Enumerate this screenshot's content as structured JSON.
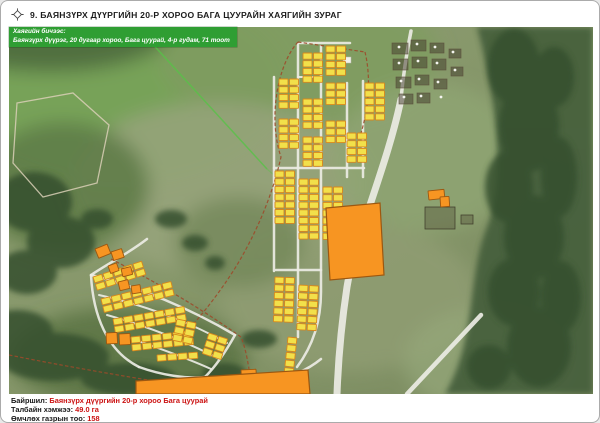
{
  "header": {
    "title": "9. БАЯНЗҮРХ ДҮҮРГИЙН 20-Р ХОРОО БАГА ЦУУРАЙН ХАЯГИЙН ЗУРАГ"
  },
  "overlay": {
    "label": "Хаягийн бичээс:",
    "address": "Баянзүрх дүүрэг, 20 дугаар хороо, Бага цуурай, 4-р гудам, 71 тоот",
    "bg": "#2f9e33",
    "text_color": "#ffffff"
  },
  "footer": {
    "location_label": "Байршил:",
    "location_value": "Баянзүрх дүүргийн 20-р хороо Бага цуурай",
    "area_label": "Талбайн хэмжээ:",
    "area_value": "49.0 га",
    "count_label": "Өмчлөх газрын тоо:",
    "count_value": "158",
    "value_color": "#cc1414"
  },
  "map": {
    "colors": {
      "base1": "#90a173",
      "base2": "#7b8b60",
      "yellow": "#f2e04a",
      "yellow_stroke": "#d8871c",
      "orange": "#f79522",
      "orange_stroke": "#9c5710",
      "road": "#ececе4",
      "road2": "#ececе4",
      "road_fill": "#ecece4",
      "boundary": "#9c4a2a",
      "green_line": "#58c247",
      "forest": "#46603e",
      "forest_dark": "#35502f",
      "plot_fill": "rgba(66,58,44,0.5)",
      "plot_stroke": "rgba(92,80,60,0.85)",
      "dot": "#f5f5f0",
      "trail": "#d9cfb6"
    },
    "terrain_blobs": [
      [
        110,
        50,
        170,
        100,
        "#76a257",
        0.95
      ],
      [
        290,
        20,
        140,
        70,
        "#7f9c60",
        0.9
      ],
      [
        40,
        -5,
        120,
        40,
        "#4c6a3d",
        0.9
      ],
      [
        210,
        150,
        150,
        85,
        "#97a37b",
        0.85
      ],
      [
        420,
        120,
        95,
        75,
        "#8fa573",
        0.8
      ],
      [
        340,
        260,
        130,
        75,
        "#909d73",
        0.8
      ],
      [
        480,
        325,
        85,
        55,
        "#95a87b",
        0.7
      ],
      [
        55,
        150,
        85,
        65,
        "#5d7a46",
        0.85
      ],
      [
        230,
        205,
        65,
        45,
        "#6f8455",
        0.7
      ],
      [
        575,
        55,
        50,
        60,
        "#8ba66c",
        0.8
      ],
      [
        120,
        320,
        120,
        50,
        "#5a7343",
        0.85
      ]
    ],
    "forest_right": "M468,-10 L584,-10 L584,357 L436,357 C468,302 458,240 478,190 C498,140 486,58 468,-10 Z",
    "forest_blobs": [
      [
        505,
        30,
        26,
        38
      ],
      [
        520,
        90,
        30,
        45
      ],
      [
        500,
        150,
        24,
        36
      ],
      [
        525,
        200,
        30,
        42
      ],
      [
        505,
        255,
        26,
        34
      ],
      [
        530,
        310,
        32,
        40
      ],
      [
        480,
        330,
        22,
        22
      ],
      [
        545,
        40,
        20,
        30
      ],
      [
        550,
        140,
        18,
        40
      ],
      [
        552,
        260,
        20,
        36
      ],
      [
        25,
        165,
        38,
        30
      ],
      [
        52,
        205,
        34,
        26
      ],
      [
        18,
        235,
        30,
        22
      ],
      [
        88,
        182,
        16,
        10
      ],
      [
        45,
        320,
        55,
        24
      ],
      [
        120,
        342,
        48,
        16
      ],
      [
        188,
        352,
        38,
        12
      ],
      [
        8,
        295,
        36,
        22
      ],
      [
        162,
        182,
        16,
        9
      ],
      [
        186,
        206,
        13,
        8
      ],
      [
        206,
        226,
        10,
        7
      ],
      [
        250,
        302,
        18,
        9
      ],
      [
        215,
        336,
        22,
        10
      ],
      [
        240,
        352,
        16,
        8
      ]
    ],
    "light_polygon": "8,66 64,56 100,88 88,146 34,160 4,126",
    "green_line": [
      "M128,-10 L258,132",
      "M258,132 L302,170"
    ],
    "roads": [
      {
        "d": "M392,62 C378,130 346,200 338,250 C331,296 329,330 328,357",
        "w": 7
      },
      {
        "d": "M392,62 C394,40 398,14 402,-6",
        "w": 3.5
      },
      {
        "d": "M472,278 L398,357",
        "w": 4.5
      },
      {
        "d": "M291,6 L341,6",
        "w": 2.5
      },
      {
        "d": "M265,40 L265,234",
        "w": 2.5
      },
      {
        "d": "M289,7 L289,300",
        "w": 2.5
      },
      {
        "d": "M312,9 L312,255 C312,285 303,310 288,330",
        "w": 2.5
      },
      {
        "d": "M338,46 L338,140",
        "w": 2.5
      },
      {
        "d": "M354,44 L354,140",
        "w": 2.5
      },
      {
        "d": "M265,131 L355,131",
        "w": 2.5
      },
      {
        "d": "M267,233 L312,233",
        "w": 2.5
      },
      {
        "d": "M289,40 L312,40",
        "w": 2
      },
      {
        "d": "M138,202 C120,216 100,226 82,238",
        "w": 2.5
      },
      {
        "d": "M82,238 C130,250 182,272 226,298",
        "w": 2.5
      },
      {
        "d": "M226,298 C216,316 206,330 196,340",
        "w": 2.5
      },
      {
        "d": "M82,238 C84,278 98,314 130,330",
        "w": 2.5
      },
      {
        "d": "M130,330 C152,338 178,342 196,340",
        "w": 2.5
      },
      {
        "d": "M90,258 C140,269 186,288 218,306",
        "w": 2
      },
      {
        "d": "M98,278 C144,291 180,306 210,322",
        "w": 2
      },
      {
        "d": "M112,298 C150,311 180,322 202,332",
        "w": 2
      },
      {
        "d": "M196,340 C243,352 285,344 312,322",
        "w": 2.5
      }
    ],
    "boundary_paths": [
      "M289,5 L356,15",
      "M289,5 C268,28 259,82 272,120 C263,160 247,196 228,228 C212,254 193,278 178,294",
      "M356,15 C362,40 360,70 352,96",
      "M102,222 C145,244 190,270 232,300 C236,310 238,320 240,332",
      "M0,318 C60,330 130,342 196,352"
    ],
    "yellow_strips": [
      {
        "x": 317,
        "y": 9,
        "c": 2,
        "r": 4,
        "rot": 0
      },
      {
        "x": 294,
        "y": 16,
        "c": 2,
        "r": 4,
        "rot": 0
      },
      {
        "x": 270,
        "y": 42,
        "c": 2,
        "r": 4,
        "rot": 0
      },
      {
        "x": 317,
        "y": 46,
        "c": 2,
        "r": 3,
        "rot": 0
      },
      {
        "x": 294,
        "y": 62,
        "c": 2,
        "r": 4,
        "rot": 0
      },
      {
        "x": 356,
        "y": 46,
        "c": 2,
        "r": 5,
        "rot": 0
      },
      {
        "x": 270,
        "y": 82,
        "c": 2,
        "r": 4,
        "rot": 0
      },
      {
        "x": 294,
        "y": 100,
        "c": 2,
        "r": 4,
        "rot": 0
      },
      {
        "x": 317,
        "y": 84,
        "c": 2,
        "r": 3,
        "rot": 0
      },
      {
        "x": 338,
        "y": 96,
        "c": 2,
        "r": 4,
        "rot": 0
      },
      {
        "x": 266,
        "y": 134,
        "c": 2,
        "r": 7,
        "rot": 0
      },
      {
        "x": 290,
        "y": 142,
        "c": 2,
        "r": 8,
        "rot": 0
      },
      {
        "x": 314,
        "y": 150,
        "c": 2,
        "r": 7,
        "rot": 0
      },
      {
        "x": 266,
        "y": 240,
        "c": 2,
        "r": 6,
        "rot": 2
      },
      {
        "x": 290,
        "y": 248,
        "c": 2,
        "r": 6,
        "rot": 3
      },
      {
        "x": 279,
        "y": 300,
        "c": 1,
        "r": 7,
        "rot": 6
      },
      {
        "x": 84,
        "y": 240,
        "c": 5,
        "r": 2,
        "rot": -18
      },
      {
        "x": 92,
        "y": 262,
        "c": 7,
        "r": 2,
        "rot": -14
      },
      {
        "x": 104,
        "y": 282,
        "c": 7,
        "r": 2,
        "rot": -10
      },
      {
        "x": 122,
        "y": 300,
        "c": 6,
        "r": 2,
        "rot": -6
      },
      {
        "x": 168,
        "y": 282,
        "c": 2,
        "r": 3,
        "rot": 12
      },
      {
        "x": 200,
        "y": 296,
        "c": 2,
        "r": 3,
        "rot": 18
      },
      {
        "x": 148,
        "y": 318,
        "c": 4,
        "r": 1,
        "rot": -4
      }
    ],
    "cell": {
      "w": 9,
      "h": 6.2,
      "gap": 1.5
    },
    "orange_parcels": [
      {
        "x": 86,
        "y": 212,
        "w": 13,
        "h": 10,
        "rot": -22
      },
      {
        "x": 102,
        "y": 215,
        "w": 11,
        "h": 9,
        "rot": -18
      },
      {
        "x": 99,
        "y": 229,
        "w": 9,
        "h": 8,
        "rot": -20
      },
      {
        "x": 112,
        "y": 232,
        "w": 10,
        "h": 8,
        "rot": -14
      },
      {
        "x": 109,
        "y": 245,
        "w": 10,
        "h": 9,
        "rot": -14
      },
      {
        "x": 122,
        "y": 249,
        "w": 9,
        "h": 8,
        "rot": -9
      },
      {
        "x": 97,
        "y": 296,
        "w": 11,
        "h": 11,
        "rot": -3
      },
      {
        "x": 110,
        "y": 297,
        "w": 11,
        "h": 11,
        "rot": -3
      },
      {
        "x": 419,
        "y": 154,
        "w": 16,
        "h": 9,
        "rot": -6
      },
      {
        "x": 431,
        "y": 160,
        "w": 9,
        "h": 10,
        "rot": -4
      },
      {
        "x": 232,
        "y": 333,
        "w": 15,
        "h": 8,
        "rot": -3
      }
    ],
    "big_orange": [
      "317,171 371,166 375,238 321,243",
      "127,344 299,333 301,357 127,357"
    ],
    "ger_plots": [
      [
        383,
        6,
        16,
        11
      ],
      [
        402,
        3,
        15,
        11
      ],
      [
        421,
        6,
        14,
        10
      ],
      [
        384,
        22,
        15,
        11
      ],
      [
        403,
        20,
        15,
        11
      ],
      [
        423,
        22,
        14,
        11
      ],
      [
        387,
        40,
        15,
        11
      ],
      [
        406,
        38,
        14,
        10
      ],
      [
        425,
        42,
        13,
        10
      ],
      [
        390,
        57,
        14,
        10
      ],
      [
        408,
        56,
        13,
        10
      ],
      [
        440,
        12,
        12,
        9
      ],
      [
        442,
        30,
        12,
        9
      ]
    ],
    "ger_dots": [
      [
        390,
        10
      ],
      [
        408,
        7
      ],
      [
        426,
        10
      ],
      [
        390,
        26
      ],
      [
        409,
        24
      ],
      [
        428,
        26
      ],
      [
        392,
        44
      ],
      [
        410,
        42
      ],
      [
        429,
        45
      ],
      [
        395,
        60
      ],
      [
        412,
        59
      ],
      [
        444,
        15
      ],
      [
        446,
        33
      ],
      [
        432,
        60
      ]
    ],
    "compounds": [
      [
        416,
        170,
        30,
        22
      ],
      [
        452,
        178,
        12,
        9
      ]
    ],
    "white_buildings": [
      [
        334,
        20,
        8,
        6
      ]
    ]
  }
}
